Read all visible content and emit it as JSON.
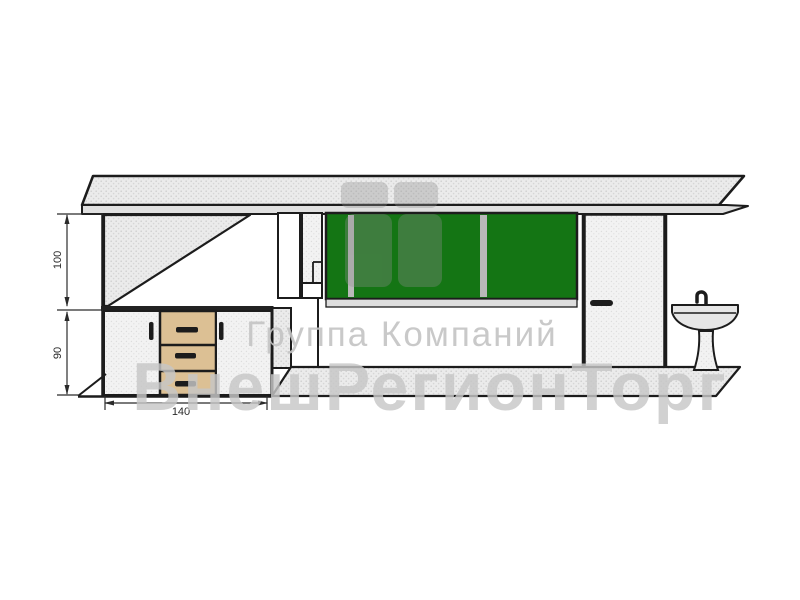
{
  "drawing": {
    "dimensions": {
      "wall_upper": "100",
      "wall_lower": "90",
      "counter_width": "140"
    },
    "watermark": {
      "company_line": "Группа Компаний",
      "brand_line": "ВнешРегионТорг"
    },
    "colors": {
      "window_green": "#147514",
      "cabinet_wood": "#dcc094",
      "outline": "#1c1c1c",
      "panel_fill": "#ebebeb",
      "mullion_gray": "#b9b9b9",
      "watermark_gray": "#c7c7c7",
      "background": "#ffffff"
    }
  }
}
